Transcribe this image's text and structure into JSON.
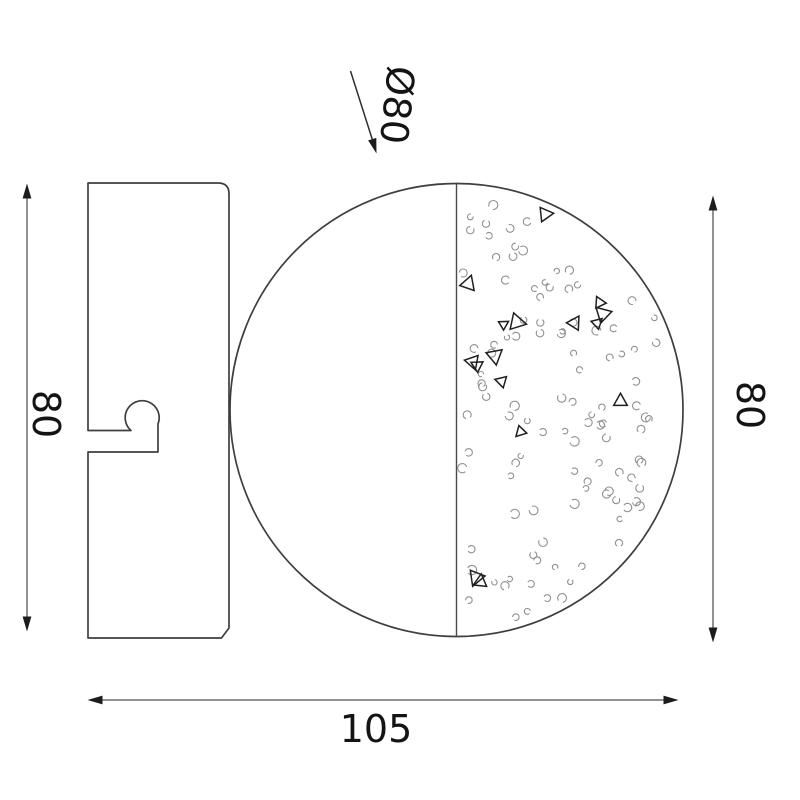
{
  "diagram": {
    "type": "technical-dimension-drawing",
    "labels": {
      "diameter": "Ø80",
      "left_height": "80",
      "right_height": "80",
      "bottom_width": "105"
    },
    "colors": {
      "outline": "#3f3f3f",
      "center_line": "#4a4a4a",
      "dimension_line": "#6f6f6f",
      "arrowhead": "#1c1c1c",
      "text": "#141414",
      "texture_dot": "#909090",
      "texture_triangle": "#1f1f1f",
      "background": "#ffffff"
    },
    "texture": {
      "seed": 12,
      "dot_count": 108,
      "triangle_count": 16
    }
  }
}
